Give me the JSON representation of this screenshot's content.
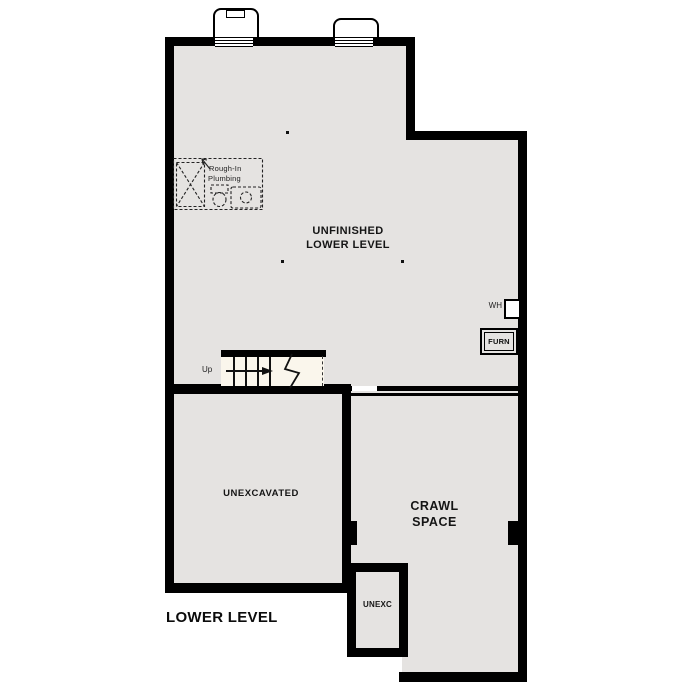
{
  "plan": {
    "title": "LOWER LEVEL",
    "rooms": {
      "unfinished": {
        "line1": "UNFINISHED",
        "line2": "LOWER LEVEL"
      },
      "unexcavated": {
        "label": "UNEXCAVATED"
      },
      "crawl_space": {
        "line1": "CRAWL",
        "line2": "SPACE"
      },
      "unexc": {
        "label": "UNEXC"
      }
    },
    "annotations": {
      "rough_in_line1": "Rough-In",
      "rough_in_line2": "Plumbing",
      "water_heater": "WH",
      "furnace": "FURN",
      "stairs_up": "Up"
    },
    "colors": {
      "wall": "#000000",
      "room_fill": "#e5e3e1",
      "stair_fill": "#faf6ec",
      "background": "#ffffff",
      "text": "#111111"
    }
  }
}
